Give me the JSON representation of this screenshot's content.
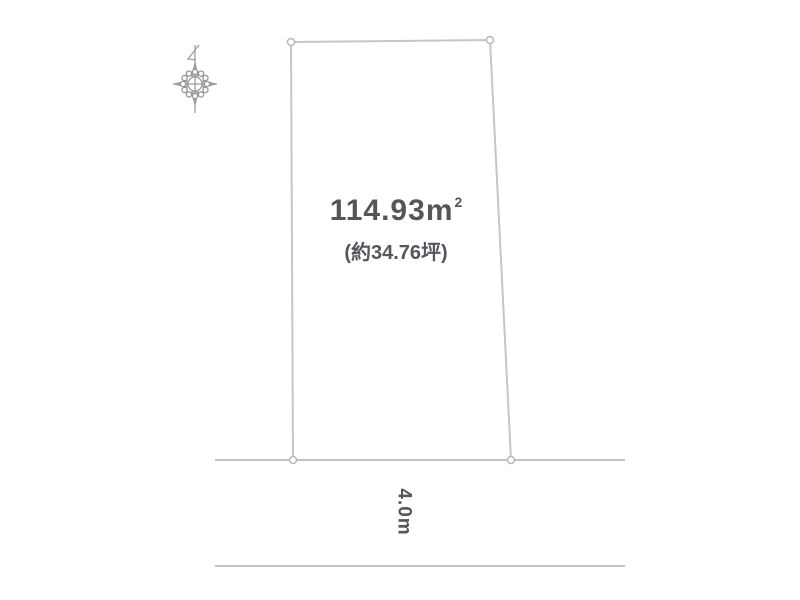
{
  "diagram": {
    "title": "land-plot-survey-diagram",
    "area_m2": {
      "value": "114.93",
      "unit": "m",
      "sup": "2"
    },
    "area_tsubo": "(約34.76坪)",
    "road_frontage": "4.0m",
    "icons": {
      "compass": "compass-north-icon"
    },
    "colors": {
      "background": "#ffffff",
      "boundary_line": "#c6c6c6",
      "road_line": "#c2c2c2",
      "marker_stroke": "#b8b8b8",
      "text": "#55555c",
      "compass": "#9e9e9e"
    }
  }
}
